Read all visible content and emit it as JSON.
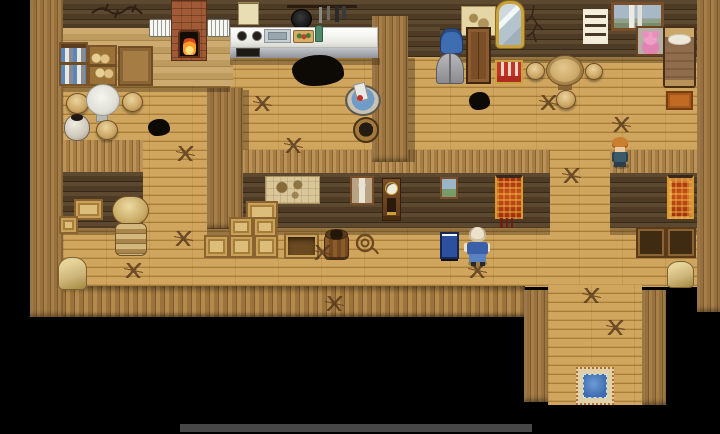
{
  "scene": {
    "name": "wooden tavern interior (top-down tile RPG view)",
    "visible_text": "none",
    "background_color": "#000000"
  },
  "palette": {
    "floor_wood": "#c99e56",
    "wall_dark_logs": "#4e3b26",
    "wall_planks": "#a87f49",
    "counter_white": "#f2f2ee",
    "fire_orange": "#ff9c2a",
    "water_blue": "#6f9cc8",
    "tapestry_red": "#b03a12",
    "doormat_blue": "#4d7dc0"
  },
  "npcs": {
    "elder": {
      "label": "white-haired villager in blue, standing by sign"
    },
    "villager": {
      "label": "orange-haired villager in dark clothes"
    }
  },
  "objects": {
    "jar_shelf": {
      "label": "shelf stocked with jars and canisters"
    },
    "bread_shelf": {
      "label": "shelf with bread and provisions"
    },
    "cupboard": {
      "label": "wooden cupboard with drawers"
    },
    "window_left": {
      "label": "white shuttered window"
    },
    "window_right": {
      "label": "white shuttered window"
    },
    "fireplace": {
      "label": "brick fireplace with burning fire"
    },
    "notice": {
      "label": "paper notice pinned to wall"
    },
    "utensil_rack": {
      "label": "hanging pan and kitchen utensils"
    },
    "stove": {
      "label": "stove burners"
    },
    "sink": {
      "label": "metal sink"
    },
    "cutting_board": {
      "label": "cutting board with vegetables"
    },
    "counter": {
      "label": "white kitchen counter"
    },
    "wash_tub": {
      "label": "washing tub with washboard"
    },
    "bucket": {
      "label": "water bucket"
    },
    "white_table": {
      "label": "round marble table"
    },
    "stool": {
      "label": "wooden stool"
    },
    "vase": {
      "label": "ceramic pot"
    },
    "wall_map_small": {
      "label": "parchment map on wall"
    },
    "mirror": {
      "label": "ornate gold mirror"
    },
    "wall_crack": {
      "label": "crack in the log wall"
    },
    "lattice_window": {
      "label": "paned window"
    },
    "castle_painting": {
      "label": "framed castle landscape painting"
    },
    "bear_picture": {
      "label": "framed pink teddy bear picture"
    },
    "bed": {
      "label": "single bed with brown blanket"
    },
    "blue_shirt": {
      "label": "blue shirt hanging on rack"
    },
    "grey_coat": {
      "label": "grey coat hanging on rack"
    },
    "wardrobe": {
      "label": "tall wooden wardrobe"
    },
    "striped_chest": {
      "label": "red striped chest"
    },
    "round_table": {
      "label": "round wooden table"
    },
    "orange_box": {
      "label": "orange storage box"
    },
    "wall_map_large": {
      "label": "large survey map on wall"
    },
    "portrait": {
      "label": "framed portrait"
    },
    "clock": {
      "label": "grandfather clock"
    },
    "small_painting": {
      "label": "small framed landscape"
    },
    "tapestry_left": {
      "label": "red tapestry banner"
    },
    "tapestry_right": {
      "label": "red and gold tapestry banner"
    },
    "crates": {
      "label": "stacked wooden crates"
    },
    "open_crate": {
      "label": "open empty crate"
    },
    "barrel": {
      "label": "wooden barrel"
    },
    "rope_coil": {
      "label": "coiled rope on floor"
    },
    "sign_board": {
      "label": "blue sign board"
    },
    "hay_roll": {
      "label": "rolled bales of straw"
    },
    "sack": {
      "label": "grain sack"
    },
    "empty_shelf": {
      "label": "empty wooden shelf box"
    },
    "doormat": {
      "label": "blue entry doormat"
    },
    "floor_stain": {
      "label": "dark stain"
    },
    "scratch_marks": {
      "label": "claw scratch marks"
    },
    "vine_decor": {
      "label": "dry vine on wall"
    }
  }
}
